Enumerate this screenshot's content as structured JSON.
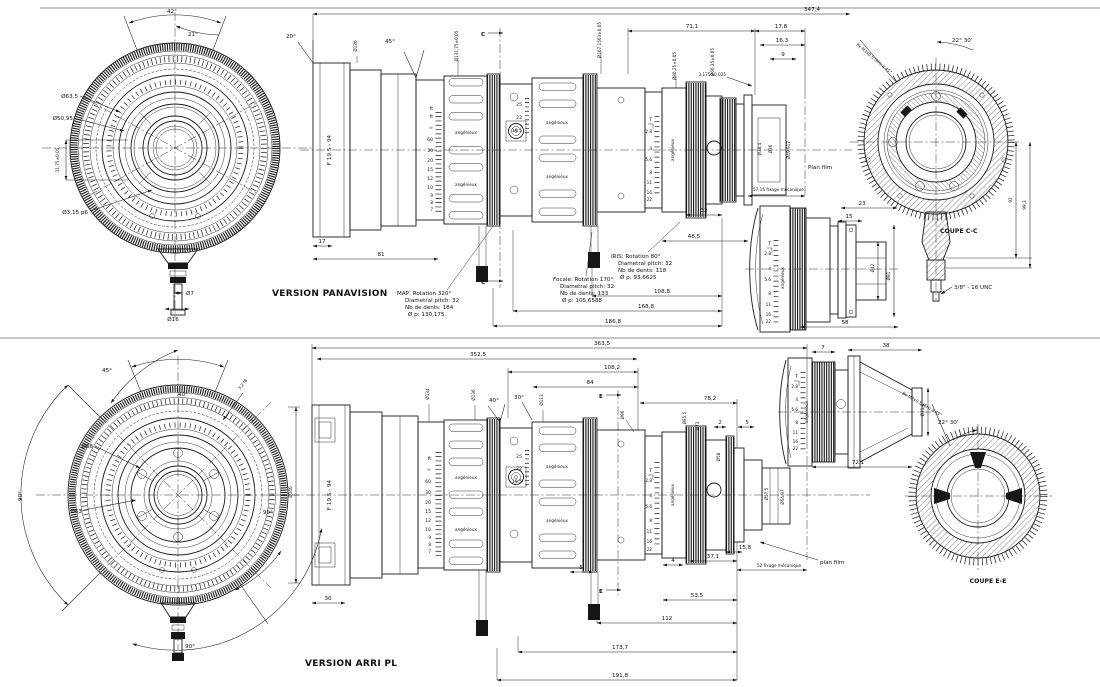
{
  "lens": {
    "brand": "angénieux",
    "model": "F 19.5 - 94"
  },
  "scales": {
    "ft": "ft",
    "focus": [
      "∞",
      "60",
      "30",
      "20",
      "15",
      "12",
      "10",
      "9",
      "8",
      "7"
    ],
    "zoom": [
      "25",
      "22",
      "19.5"
    ],
    "iris_t": "T",
    "iris": [
      "2.8",
      "4",
      "5.6",
      "8",
      "11",
      "16",
      "22"
    ]
  },
  "top": {
    "version": "VERSION PANAVISION",
    "front": {
      "a42": "42°",
      "a21": "21°",
      "d1": "Ø63,5",
      "d2": "Ø50,95",
      "d3": "31,75±0,05",
      "d4": "Ø3,15 p6",
      "d5": "Ø7",
      "d6": "Ø16"
    },
    "side": {
      "a20": "20°",
      "a45": "45°",
      "dia_hood": "Ø136",
      "dia_map": "Ø131,75±0,05",
      "dia_foc": "Ø107,1563±0,05",
      "dia_iris": "Ø80,25±0,05",
      "dia_rear": "Ø66,35±0,05",
      "dia_m1": "Ø38,4",
      "dia_m2": "Ø36",
      "dia_m3": "Ø49,917",
      "plan": "Plan film",
      "fix": "57,15 fixage mécanique",
      "sec": "C",
      "d_total": "347,4",
      "d71": "71,1",
      "d178": "17,8",
      "d163": "16,3",
      "d9": "9",
      "d317": "3,175±0,025",
      "d17": "17",
      "d81": "81",
      "d32": "32",
      "d485": "48,5",
      "dA": "108,8",
      "dB": "168,8",
      "dC": "186,8",
      "note_map": [
        "MAP: Rotation 320°",
        "Diametral pitch: 32",
        "Nb de dents: 184",
        "Ø p: 130,175"
      ],
      "note_foc": [
        "Focale: Rotation 170°",
        "Diametral pitch: 32",
        "Nb de dents: 133",
        "Ø p: 105,6588"
      ],
      "note_iris": [
        "IRIS: Rotation 80°",
        "Diametral pitch: 32",
        "Nb de dents: 118",
        "Ø p: 93,6625"
      ]
    },
    "detail": {
      "d23": "23",
      "d15": "15",
      "dia42": "Ø42",
      "dia81": "Ø81",
      "d58": "58"
    },
    "coupe": {
      "title": "COUPE C-C",
      "screw": "8x M3x0.5 (6H) à 45°",
      "angle": "22° 30'",
      "d92": "92",
      "d993": "99,3",
      "unc": "3/8\" - 16 UNC"
    }
  },
  "bottom": {
    "version": "VERSION ARRI PL",
    "front": {
      "a45": "45°",
      "a40": "40°",
      "rough": "3,2 f8",
      "d1": "Ø68",
      "d2": "Ø63",
      "a90l": "90°",
      "a90r": "90°",
      "a90b": "90°",
      "dia140": "Ø140"
    },
    "side": {
      "a40": "40°",
      "a30": "30°",
      "dia134": "Ø134",
      "dia136": "Ø136",
      "dia113": "Ø113",
      "dia96": "Ø96",
      "dia855": "Ø85,5",
      "dia73": "Ø73",
      "dia58": "Ø58",
      "dia575": "Ø57,5",
      "dia5497": "Ø54,97",
      "plan": "plan film",
      "fix": "52 fixage mécanique",
      "sec": "E",
      "d_total": "363,5",
      "d_inner": "352,5",
      "d1082": "108,2",
      "d84": "84",
      "d782": "78,2",
      "d2": "2",
      "d5": "5",
      "d30": "30",
      "d158": "15,8",
      "d371": "37,1",
      "d4": "4",
      "d5b": "5",
      "d535": "53,5",
      "d112": "112",
      "d1737": "173,7",
      "d1918": "191,8"
    },
    "detail": {
      "d7": "7",
      "d38": "38",
      "d721": "72,1",
      "dia718": "Ø71,8"
    },
    "coupe": {
      "title": "COUPE E-E",
      "screw": "8x M2x0.5 (6H) à 45°",
      "angle": "22° 30'"
    }
  }
}
